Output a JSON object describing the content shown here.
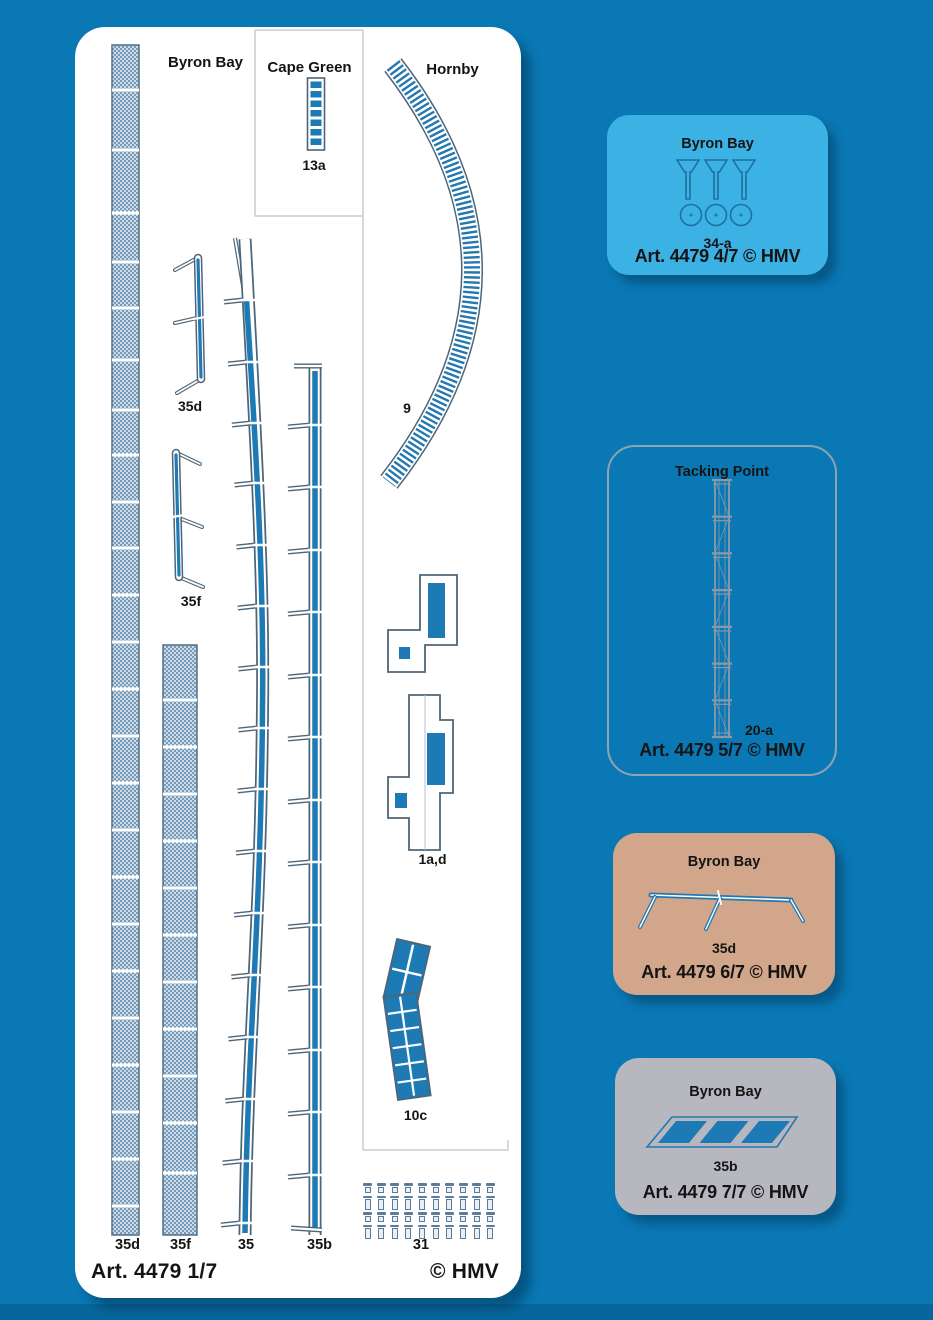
{
  "sheet": {
    "region_byron": "Byron Bay",
    "region_cape": "Cape Green",
    "region_hornby": "Hornby",
    "label_13a": "13a",
    "label_9": "9",
    "label_35d_part": "35d",
    "label_35f_part": "35f",
    "label_1ad": "1a,d",
    "label_10c": "10c",
    "bottom_labels": [
      "35d",
      "35f",
      "35",
      "35b",
      "31"
    ],
    "footer_left": "Art. 4479 1/7",
    "footer_right": "© HMV",
    "screw_rows": [
      {
        "size": "s",
        "count": 10
      },
      {
        "size": "l",
        "count": 10
      },
      {
        "size": "s",
        "count": 10
      },
      {
        "size": "l",
        "count": 10
      }
    ]
  },
  "cards": [
    {
      "title": "Byron Bay",
      "part_label": "34-a",
      "footer": "Art. 4479 4/7 © HMV",
      "bg_color": "#3cb1e4"
    },
    {
      "title": "Tacking Point",
      "part_label": "20-a",
      "footer": "Art. 4479 5/7 © HMV",
      "bg_color": "transparent"
    },
    {
      "title": "Byron Bay",
      "part_label": "35d",
      "footer": "Art. 4479 6/7 © HMV",
      "bg_color": "#d2a68a"
    },
    {
      "title": "Byron Bay",
      "part_label": "35b",
      "footer": "Art. 4479 7/7 © HMV",
      "bg_color": "#b7b7bf"
    }
  ],
  "colors": {
    "background": "#0a78b4",
    "part_blue": "#1d7ab5",
    "outline_slate": "#4e6577",
    "card_line_blue": "#2478ae",
    "frame_gray": "#c9ced3"
  }
}
